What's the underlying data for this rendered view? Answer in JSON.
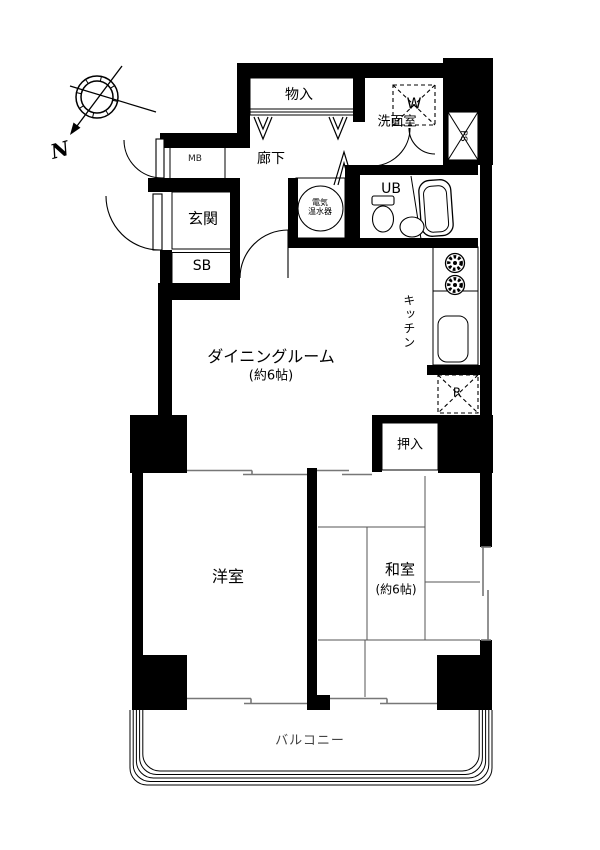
{
  "floorplan": {
    "compass": {
      "north_label": "N"
    },
    "rooms": {
      "storage_top": {
        "label": "物入"
      },
      "corridor": {
        "label": "廊下"
      },
      "meter_box": {
        "label": "MB"
      },
      "entrance": {
        "label": "玄関"
      },
      "shoe_box": {
        "label": "SB"
      },
      "washroom": {
        "label": "洗面室"
      },
      "washing_machine": {
        "label": "W"
      },
      "pipe_shaft": {
        "label": "PS"
      },
      "unit_bath": {
        "label": "UB"
      },
      "water_heater": {
        "label_line1": "電気",
        "label_line2": "温水器"
      },
      "kitchen": {
        "label": "キッチン"
      },
      "refrigerator": {
        "label": "R"
      },
      "dining": {
        "label": "ダイニングルーム",
        "size_label": "(約6帖)"
      },
      "closet": {
        "label": "押入"
      },
      "western_room": {
        "label": "洋室"
      },
      "japanese_room": {
        "label": "和室",
        "size_label": "(約6帖)"
      },
      "balcony": {
        "label": "バルコニー"
      }
    }
  }
}
